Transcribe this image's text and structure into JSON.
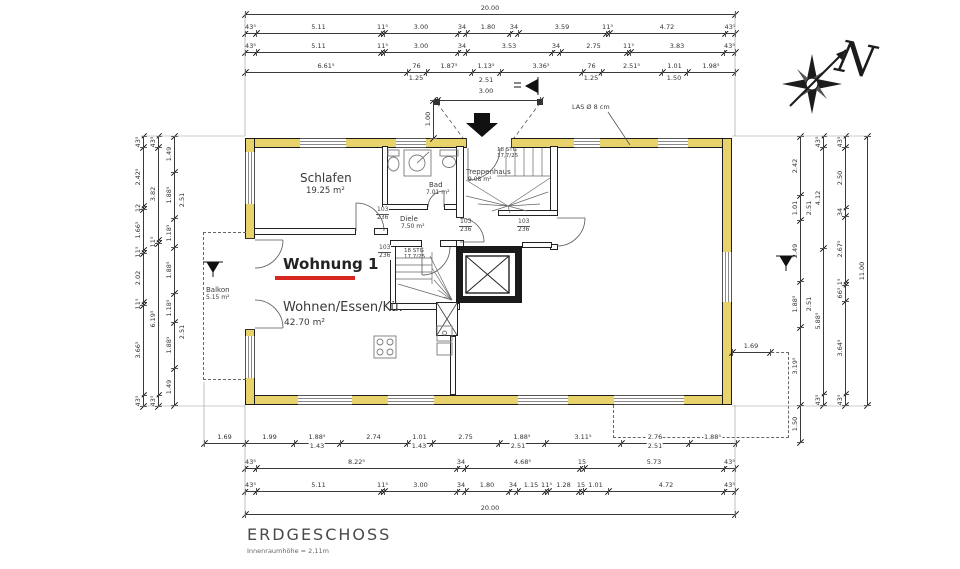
{
  "title": {
    "name": "ERDGESCHOSS",
    "note": "Innenraumhöhe = 2,11m"
  },
  "compass": {
    "letter": "N"
  },
  "apartment": {
    "label": "Wohnung 1",
    "x": 283,
    "y": 256,
    "underline": [
      275,
      276,
      80,
      4
    ],
    "underline_color": "#d7261d"
  },
  "vent_note": {
    "text": "LAS Ø 8 cm",
    "x": 572,
    "y": 104
  },
  "door_size": {
    "w": "103",
    "h": "236"
  },
  "stair_note": [
    "18 STG",
    "17,7/25"
  ],
  "stair_note_pos": [
    {
      "x": 497,
      "y": 147
    },
    {
      "x": 404,
      "y": 248
    }
  ],
  "rooms": [
    {
      "name": "Schlafen",
      "area": "19.25 m²",
      "x": 300,
      "y": 172,
      "ns": 12,
      "as": 8.5,
      "ax": 6,
      "ay": 15
    },
    {
      "name": "Bad",
      "area": "7.01 m²",
      "x": 429,
      "y": 181,
      "ns": 7,
      "as": 6,
      "ax": -3,
      "ay": 9
    },
    {
      "name": "Treppenhaus",
      "area": "9.08 m²",
      "x": 466,
      "y": 168,
      "ns": 7,
      "as": 6,
      "ax": 2,
      "ay": 9
    },
    {
      "name": "Diele",
      "area": "7.50 m²",
      "x": 400,
      "y": 215,
      "ns": 7,
      "as": 6,
      "ax": 1,
      "ay": 9
    },
    {
      "name": "Wohnen/Essen/Kü.",
      "area": "42.70 m²",
      "x": 283,
      "y": 301,
      "ns": 13,
      "as": 9,
      "ax": 1,
      "ay": 17
    },
    {
      "name": "Balkon",
      "area": "5.15 m²",
      "x": 206,
      "y": 286,
      "ns": 7,
      "as": 6,
      "ax": 0,
      "ay": 9
    }
  ],
  "door_labels": [
    {
      "x": 376,
      "y": 207
    },
    {
      "x": 378,
      "y": 245
    },
    {
      "x": 459,
      "y": 219
    },
    {
      "x": 517,
      "y": 219
    }
  ],
  "dim_chains": [
    {
      "o": "h",
      "x": 245,
      "y": 14,
      "segs": [
        [
          "20.00",
          490
        ]
      ]
    },
    {
      "o": "h",
      "x": 245,
      "y": 33,
      "segs": [
        [
          "43⁵",
          11
        ],
        [
          "5.11",
          125
        ],
        [
          "11⁵",
          3
        ],
        [
          "3.00",
          74
        ],
        [
          "34",
          8
        ],
        [
          "1.80",
          44
        ],
        [
          "34",
          8
        ],
        [
          "3.59",
          88
        ],
        [
          "11⁵",
          3
        ],
        [
          "4.72",
          116
        ],
        [
          "43⁵",
          10
        ]
      ]
    },
    {
      "o": "h",
      "x": 245,
      "y": 52,
      "segs": [
        [
          "43⁵",
          11
        ],
        [
          "5.11",
          125
        ],
        [
          "11⁵",
          3
        ],
        [
          "3.00",
          74
        ],
        [
          "34",
          8
        ],
        [
          "3.53",
          86
        ],
        [
          "34",
          8
        ],
        [
          "2.75",
          67
        ],
        [
          "11⁵",
          3
        ],
        [
          "3.83",
          94
        ],
        [
          "43⁵",
          11
        ]
      ]
    },
    {
      "o": "h",
      "x": 245,
      "y": 72,
      "segs": [
        [
          "6.61⁵",
          162
        ],
        [
          "76",
          19
        ],
        [
          "1.87⁵",
          46
        ],
        [
          "1.13⁵",
          28
        ],
        [
          "3.36⁵",
          82
        ],
        [
          "76",
          19
        ],
        [
          "2.51⁵",
          61
        ],
        [
          "1.01",
          25
        ],
        [
          "1.98⁵",
          48
        ]
      ]
    },
    {
      "o": "h",
      "x": 437,
      "y": 100,
      "segs": [
        [
          "",
          103
        ]
      ]
    },
    {
      "o": "v",
      "x": 433,
      "y": 100,
      "segs": [
        [
          "1.00",
          38
        ]
      ]
    },
    {
      "o": "h",
      "x": 204,
      "y": 443,
      "segs": [
        [
          "1.69",
          41
        ],
        [
          "1.99",
          49
        ],
        [
          "1.88⁵",
          46
        ],
        [
          "2.74",
          67
        ],
        [
          "1.01",
          25
        ],
        [
          "2.75",
          67
        ],
        [
          "1.88⁵",
          46
        ],
        [
          "3.11⁵",
          76
        ],
        [
          "2.76",
          68
        ],
        [
          "1.88⁵",
          47
        ]
      ]
    },
    {
      "o": "h",
      "x": 245,
      "y": 468,
      "segs": [
        [
          "43⁵",
          11
        ],
        [
          "8.22⁵",
          201
        ],
        [
          "34",
          8
        ],
        [
          "4.68⁵",
          115
        ],
        [
          "15",
          4
        ],
        [
          "5.73",
          140
        ],
        [
          "43⁵",
          11
        ]
      ]
    },
    {
      "o": "h",
      "x": 245,
      "y": 491,
      "segs": [
        [
          "43⁵",
          11
        ],
        [
          "5.11",
          125
        ],
        [
          "11⁵",
          3
        ],
        [
          "3.00",
          73
        ],
        [
          "34",
          8
        ],
        [
          "1.80",
          44
        ],
        [
          "34",
          8
        ],
        [
          "1.15",
          28
        ],
        [
          "11⁵",
          3
        ],
        [
          "1.28",
          31
        ],
        [
          "15",
          4
        ],
        [
          "1.01",
          25
        ],
        [
          "4.72",
          116
        ],
        [
          "43⁵",
          11
        ]
      ]
    },
    {
      "o": "h",
      "x": 245,
      "y": 514,
      "segs": [
        [
          "20.00",
          490
        ]
      ]
    },
    {
      "o": "v",
      "x": 143,
      "y": 136,
      "segs": [
        [
          "43⁵",
          11
        ],
        [
          "2.42⁵",
          59
        ],
        [
          "12",
          3
        ],
        [
          "1.66⁵",
          41
        ],
        [
          "11⁵",
          3
        ],
        [
          "2.02",
          49
        ],
        [
          "11⁵",
          3
        ],
        [
          "3.66⁵",
          90
        ],
        [
          "43⁵",
          11
        ]
      ]
    },
    {
      "o": "v",
      "x": 158,
      "y": 136,
      "segs": [
        [
          "43⁵",
          11
        ],
        [
          "3.82",
          93
        ],
        [
          "11⁵",
          3
        ],
        [
          "6.19⁵",
          152
        ],
        [
          "43⁵",
          11
        ]
      ]
    },
    {
      "o": "v",
      "x": 174,
      "y": 136,
      "segs": [
        [
          "1.49",
          36
        ],
        [
          "1.88⁵",
          46
        ],
        [
          "1.18⁵",
          29
        ],
        [
          "1.88⁵",
          46
        ],
        [
          "1.18⁵",
          29
        ],
        [
          "1.88⁵",
          46
        ],
        [
          "1.49",
          37
        ]
      ]
    },
    {
      "o": "v",
      "x": 800,
      "y": 136,
      "segs": [
        [
          "2.42",
          59
        ],
        [
          "1.01",
          25
        ],
        [
          "2.49",
          61
        ],
        [
          "1.88⁵",
          46
        ],
        [
          "3.19⁵",
          78
        ],
        [
          "1.50",
          37
        ]
      ]
    },
    {
      "o": "v",
      "x": 823,
      "y": 136,
      "segs": [
        [
          "43⁵",
          11
        ],
        [
          "4.12",
          101
        ],
        [
          "5.88⁵",
          146
        ],
        [
          "43⁵",
          11
        ]
      ]
    },
    {
      "o": "v",
      "x": 845,
      "y": 136,
      "segs": [
        [
          "43⁵",
          11
        ],
        [
          "2.50",
          61
        ],
        [
          "34",
          8
        ],
        [
          "2.67⁵",
          66
        ],
        [
          "11⁵",
          3
        ],
        [
          "66⁵",
          16
        ],
        [
          "3.64⁵",
          93
        ],
        [
          "43⁵",
          11
        ]
      ]
    },
    {
      "o": "v",
      "x": 867,
      "y": 136,
      "segs": [
        [
          "11.00",
          269
        ]
      ]
    },
    {
      "o": "h",
      "x": 732,
      "y": 352,
      "segs": [
        [
          "1.69",
          38
        ]
      ]
    }
  ],
  "dim_extras": [
    [
      416,
      78,
      "1.25",
      0
    ],
    [
      486,
      80,
      "2.51",
      0
    ],
    [
      486,
      91,
      "3.00",
      0
    ],
    [
      591,
      78,
      "1.25",
      0
    ],
    [
      674,
      78,
      "1.50",
      0
    ],
    [
      317,
      446,
      "1.43",
      0
    ],
    [
      419,
      446,
      "1.43",
      0
    ],
    [
      518,
      446,
      "2.51",
      0
    ],
    [
      655,
      446,
      "2.51",
      0
    ],
    [
      182,
      200,
      "2.51",
      1
    ],
    [
      182,
      332,
      "2.51",
      1
    ],
    [
      809,
      208,
      "2.51",
      1
    ],
    [
      809,
      304,
      "2.51",
      1
    ]
  ],
  "geometry": {
    "walls": [
      [
        245,
        138,
        487,
        10,
        "ext"
      ],
      [
        245,
        395,
        487,
        10,
        "ext"
      ],
      [
        245,
        138,
        10,
        267,
        "ext"
      ],
      [
        722,
        138,
        10,
        267,
        "ext"
      ],
      [
        382,
        146,
        6,
        64,
        "int"
      ],
      [
        382,
        204,
        46,
        6,
        "int"
      ],
      [
        444,
        204,
        16,
        6,
        "int"
      ],
      [
        456,
        146,
        8,
        72,
        "int"
      ],
      [
        456,
        240,
        8,
        10,
        "int"
      ],
      [
        254,
        228,
        102,
        7,
        "int"
      ],
      [
        374,
        228,
        14,
        7,
        "int"
      ],
      [
        550,
        146,
        8,
        70,
        "int"
      ],
      [
        550,
        244,
        8,
        6,
        "int"
      ],
      [
        498,
        210,
        60,
        6,
        "int"
      ],
      [
        390,
        240,
        32,
        7,
        "int"
      ],
      [
        440,
        240,
        17,
        7,
        "int"
      ],
      [
        390,
        246,
        6,
        64,
        "int"
      ],
      [
        390,
        303,
        70,
        7,
        "int"
      ],
      [
        456,
        246,
        66,
        7,
        "blk"
      ],
      [
        456,
        296,
        66,
        7,
        "blk"
      ],
      [
        456,
        246,
        7,
        57,
        "blk"
      ],
      [
        515,
        246,
        7,
        57,
        "blk"
      ],
      [
        522,
        242,
        30,
        6,
        "int"
      ],
      [
        436,
        302,
        22,
        34,
        "int"
      ],
      [
        450,
        336,
        6,
        59,
        "int"
      ]
    ],
    "windows": [
      [
        300,
        138,
        46,
        10,
        "h"
      ],
      [
        396,
        138,
        30,
        10,
        "h"
      ],
      [
        574,
        138,
        26,
        10,
        "h"
      ],
      [
        658,
        138,
        30,
        10,
        "h"
      ],
      [
        298,
        395,
        54,
        10,
        "h"
      ],
      [
        388,
        395,
        46,
        10,
        "h"
      ],
      [
        518,
        395,
        50,
        10,
        "h"
      ],
      [
        614,
        395,
        70,
        10,
        "h"
      ],
      [
        245,
        152,
        10,
        52,
        "v"
      ],
      [
        245,
        336,
        10,
        42,
        "v"
      ],
      [
        722,
        252,
        10,
        50,
        "v"
      ]
    ],
    "openings": [
      [
        466,
        138,
        46,
        10,
        "h"
      ],
      [
        245,
        238,
        10,
        92,
        "v"
      ]
    ],
    "dashed": [
      {
        "r": [
          203,
          232,
          43,
          148
        ],
        "sides": "tlb"
      },
      {
        "r": [
          732,
          352,
          57,
          86
        ],
        "sides": "tr"
      },
      {
        "r": [
          613,
          405,
          176,
          33
        ],
        "sides": "lb"
      }
    ]
  }
}
